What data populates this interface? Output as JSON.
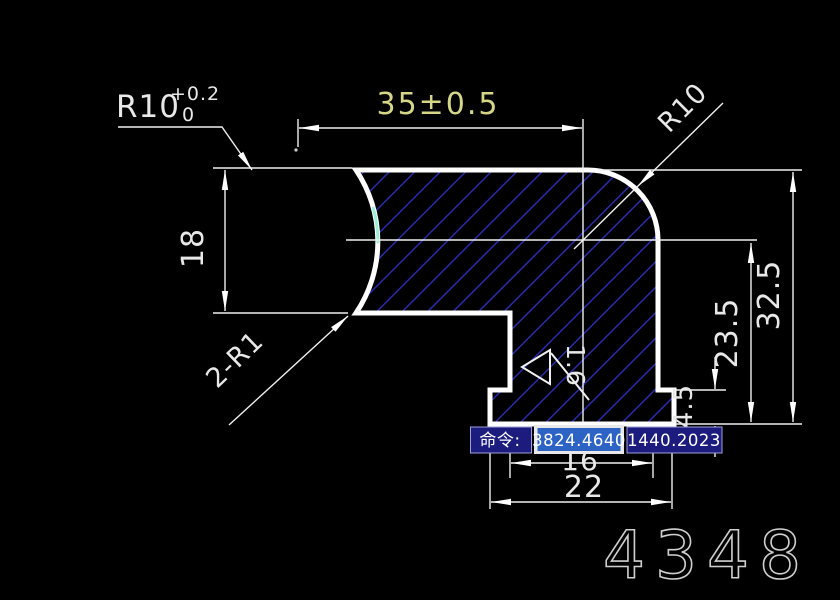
{
  "part_number": "4348",
  "command_bar": {
    "prompt": "命令:",
    "coordinate_x": "3824.4640",
    "coordinate_y": "1440.2023"
  },
  "dimensions": {
    "radius_left": "R10",
    "radius_left_tol_upper": "+0.2",
    "radius_left_tol_lower": "0",
    "width_top": "35±0.5",
    "radius_corner": "R10",
    "height_left": "18",
    "fillets_note": "2-R1",
    "height_total": "32.5",
    "height_to_center": "23.5",
    "step_height": "4.5",
    "width_inner": "16",
    "width_base": "22",
    "surface_roughness": "1.6"
  },
  "colors": {
    "background": "#000000",
    "outline": "#ffffff",
    "hatch_blue": "#20209a",
    "dim_text": "#e8e8e8",
    "tolerance_dim_text": "#d6d687",
    "highlight_arc": "#9cf0d8",
    "command_box_navy": "#1c1c7e",
    "selection_blue": "#2e63c6",
    "part_number_gray": "#cfcfcf"
  }
}
